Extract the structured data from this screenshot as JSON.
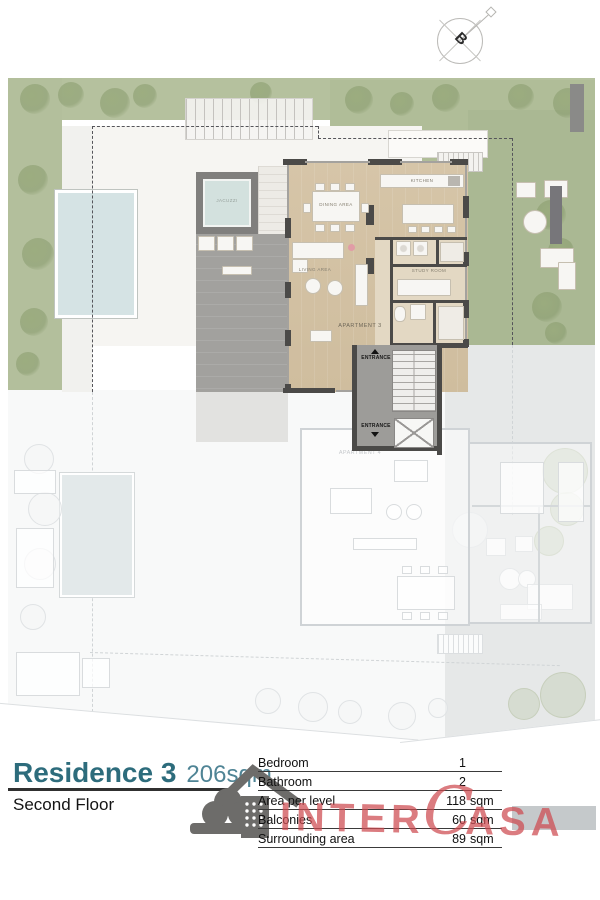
{
  "compass": {
    "letter": "B"
  },
  "plan": {
    "labels": {
      "apartment_active": "APARTMENT 3",
      "apartment_faded": "APARTMENT 4",
      "dining": "DINING AREA",
      "kitchen": "KITCHEN",
      "living": "LIVING AREA",
      "study": "STUDY ROOM",
      "jacuzzi": "JACUZZI",
      "entrance_top": "ENTRANCE",
      "entrance_bottom": "ENTRANCE"
    }
  },
  "footer": {
    "residence": "Residence 3",
    "area": "206sqm",
    "floor": "Second Floor",
    "table": {
      "rows": [
        {
          "label": "Bedroom",
          "value": "1",
          "unit": ""
        },
        {
          "label": "Bathroom",
          "value": "2",
          "unit": ""
        },
        {
          "label": "Area per level",
          "value": "118",
          "unit": "sqm"
        },
        {
          "label": "Balconies",
          "value": "60",
          "unit": "sqm"
        },
        {
          "label": "Surrounding area",
          "value": "89",
          "unit": "sqm"
        }
      ]
    },
    "watermark": {
      "pre": "INTER",
      "c": "C",
      "post": "ASA"
    }
  },
  "colors": {
    "accent_teal": "#2d6c7c",
    "accent_teal_light": "#4f8495",
    "watermark_red": "#ce4a50",
    "floor_wood": "#d6c5a8",
    "terrace_gray": "#a2a19e",
    "lawn_green": "#b5c19e",
    "pool_blue": "#d5e3e4",
    "wall_dark": "#4b4a48"
  }
}
